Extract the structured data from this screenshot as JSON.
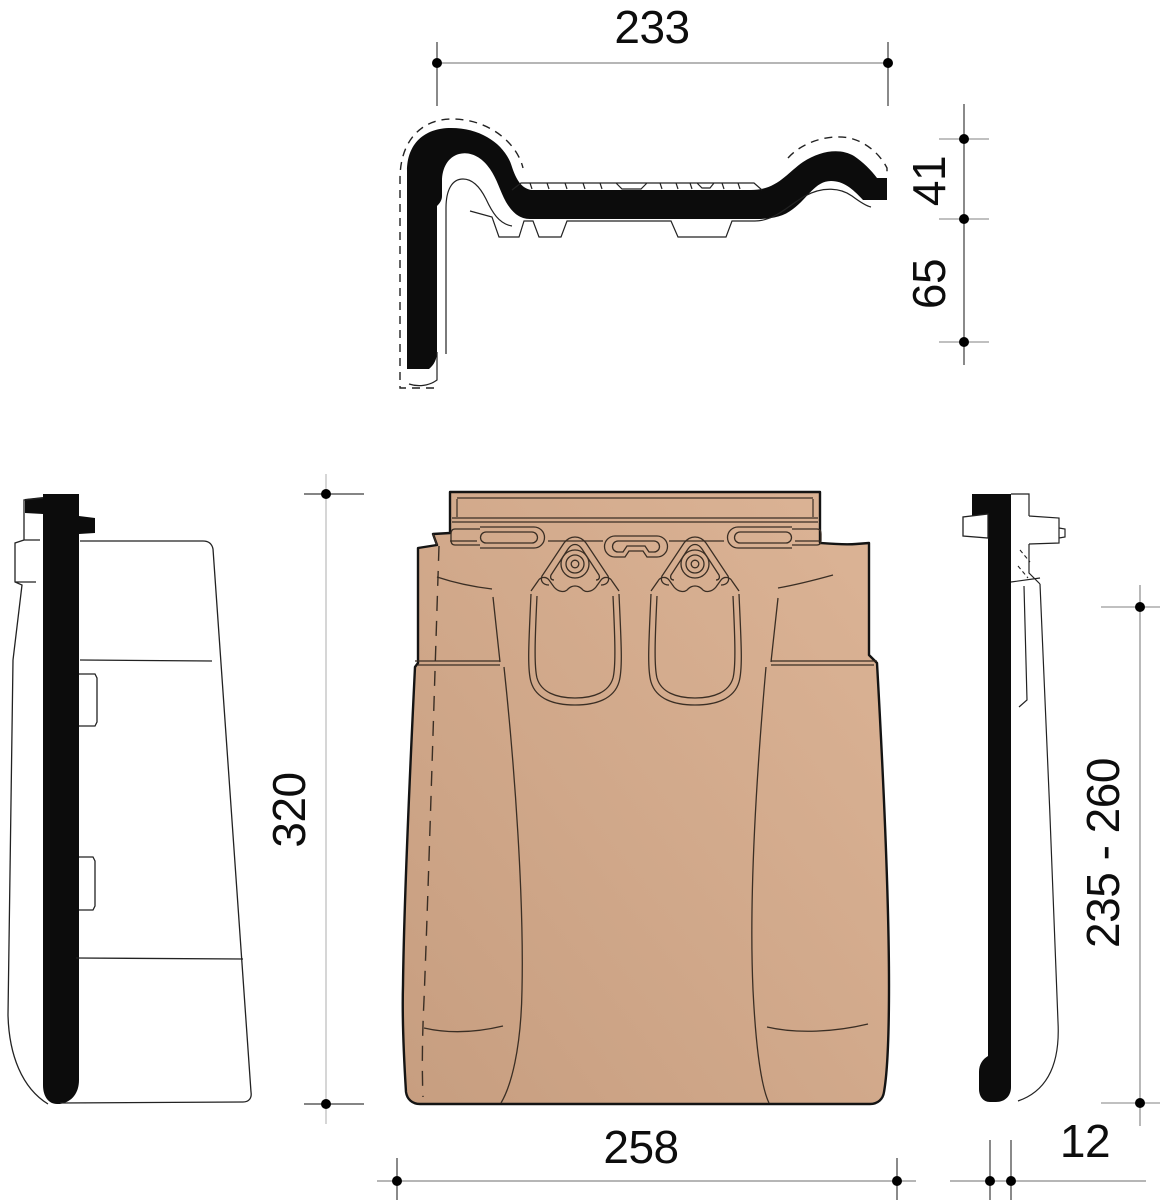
{
  "drawing": {
    "dimensions": {
      "top_width": "233",
      "profile_height": "41",
      "side_flap_height": "65",
      "tile_length": "320",
      "overall_width": "258",
      "batten_gauge_range": "235 - 260",
      "flap_thickness": "12"
    },
    "colors": {
      "tile_fill_light": "#dcb496",
      "tile_fill_dark": "#c79e80",
      "outline": "#141414",
      "detail_line": "#3a2e24",
      "dimension_line": "#9a9a9a",
      "dimension_tick": "#3c3c3c",
      "marker": "#000000",
      "background": "#ffffff"
    }
  }
}
